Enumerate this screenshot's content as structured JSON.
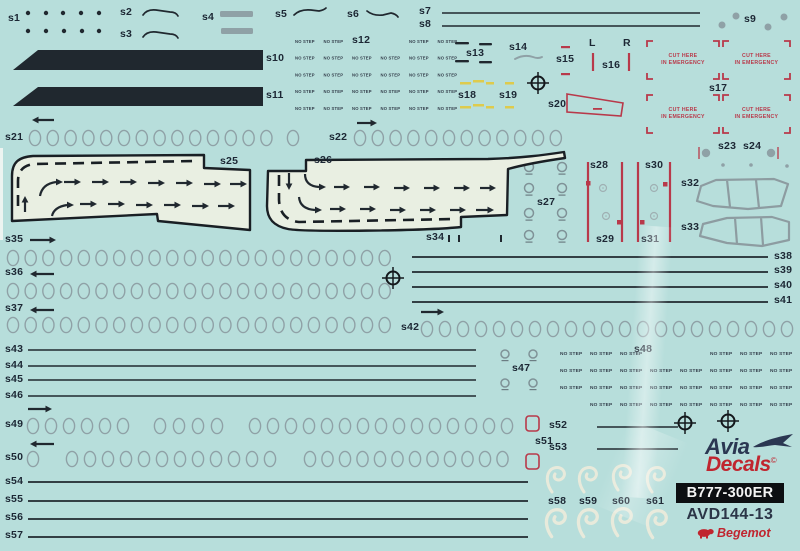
{
  "sheet": {
    "background": "#b7dedb",
    "film": "#e9efe2",
    "ink": "#20282f",
    "gray": "#8fa1a6",
    "red": "#b8394a",
    "yellow": "#decb4d",
    "cream": "#efecdb",
    "label_color": "#1c2734"
  },
  "texts": {
    "no_step": "NO STEP",
    "cut_here_line1": "CUT HERE",
    "cut_here_line2": "IN EMERGENCY"
  },
  "branding": {
    "logo_avia": "Avia",
    "logo_decals": "Decals",
    "copyright": "©",
    "model_badge": "B777-300ER",
    "sku": "AVD144-13",
    "publisher": "Begemot"
  },
  "labels": [
    {
      "t": "s1",
      "x": 8,
      "y": 13
    },
    {
      "t": "s2",
      "x": 120,
      "y": 7
    },
    {
      "t": "s3",
      "x": 120,
      "y": 29
    },
    {
      "t": "s4",
      "x": 202,
      "y": 12
    },
    {
      "t": "s5",
      "x": 275,
      "y": 9
    },
    {
      "t": "s6",
      "x": 347,
      "y": 9
    },
    {
      "t": "s7",
      "x": 419,
      "y": 6
    },
    {
      "t": "s8",
      "x": 419,
      "y": 19
    },
    {
      "t": "s9",
      "x": 744,
      "y": 14
    },
    {
      "t": "s10",
      "x": 266,
      "y": 53
    },
    {
      "t": "s11",
      "x": 266,
      "y": 90
    },
    {
      "t": "s12",
      "x": 352,
      "y": 35
    },
    {
      "t": "s13",
      "x": 466,
      "y": 48
    },
    {
      "t": "s14",
      "x": 509,
      "y": 42
    },
    {
      "t": "s15",
      "x": 556,
      "y": 54
    },
    {
      "t": "s16",
      "x": 602,
      "y": 60
    },
    {
      "t": "s17",
      "x": 709,
      "y": 83
    },
    {
      "t": "s18",
      "x": 458,
      "y": 90
    },
    {
      "t": "s19",
      "x": 499,
      "y": 90
    },
    {
      "t": "s20",
      "x": 548,
      "y": 99
    },
    {
      "t": "s21",
      "x": 5,
      "y": 132
    },
    {
      "t": "s22",
      "x": 329,
      "y": 132
    },
    {
      "t": "s23",
      "x": 718,
      "y": 141
    },
    {
      "t": "s24",
      "x": 743,
      "y": 141
    },
    {
      "t": "s25",
      "x": 220,
      "y": 156
    },
    {
      "t": "s26",
      "x": 314,
      "y": 155
    },
    {
      "t": "s27",
      "x": 537,
      "y": 197
    },
    {
      "t": "s28",
      "x": 590,
      "y": 160
    },
    {
      "t": "s29",
      "x": 596,
      "y": 234
    },
    {
      "t": "s30",
      "x": 645,
      "y": 160
    },
    {
      "t": "s31",
      "x": 641,
      "y": 234
    },
    {
      "t": "s32",
      "x": 681,
      "y": 178
    },
    {
      "t": "s33",
      "x": 681,
      "y": 222
    },
    {
      "t": "s34",
      "x": 426,
      "y": 232
    },
    {
      "t": "s35",
      "x": 5,
      "y": 234
    },
    {
      "t": "s36",
      "x": 5,
      "y": 267
    },
    {
      "t": "s37",
      "x": 5,
      "y": 303
    },
    {
      "t": "s38",
      "x": 774,
      "y": 251
    },
    {
      "t": "s39",
      "x": 774,
      "y": 265
    },
    {
      "t": "s40",
      "x": 774,
      "y": 280
    },
    {
      "t": "s41",
      "x": 774,
      "y": 295
    },
    {
      "t": "s42",
      "x": 401,
      "y": 322
    },
    {
      "t": "s43",
      "x": 5,
      "y": 344
    },
    {
      "t": "s44",
      "x": 5,
      "y": 360
    },
    {
      "t": "s45",
      "x": 5,
      "y": 374
    },
    {
      "t": "s46",
      "x": 5,
      "y": 390
    },
    {
      "t": "s47",
      "x": 512,
      "y": 363
    },
    {
      "t": "s48",
      "x": 634,
      "y": 344
    },
    {
      "t": "s49",
      "x": 5,
      "y": 419
    },
    {
      "t": "s50",
      "x": 5,
      "y": 452
    },
    {
      "t": "s51",
      "x": 535,
      "y": 436
    },
    {
      "t": "s52",
      "x": 549,
      "y": 420
    },
    {
      "t": "s53",
      "x": 549,
      "y": 442
    },
    {
      "t": "s54",
      "x": 5,
      "y": 476
    },
    {
      "t": "s55",
      "x": 5,
      "y": 494
    },
    {
      "t": "s56",
      "x": 5,
      "y": 512
    },
    {
      "t": "s57",
      "x": 5,
      "y": 530
    },
    {
      "t": "s58",
      "x": 548,
      "y": 496
    },
    {
      "t": "s59",
      "x": 579,
      "y": 496
    },
    {
      "t": "s60",
      "x": 612,
      "y": 496
    },
    {
      "t": "s61",
      "x": 646,
      "y": 496
    },
    {
      "t": "L",
      "x": 589,
      "y": 38
    },
    {
      "t": "R",
      "x": 623,
      "y": 38
    }
  ],
  "art": {
    "stripes": [
      "38,50 263,50 263,70 13,70",
      "38,87 263,87 263,106 13,106"
    ],
    "gray_bars": [
      [
        220,
        11,
        33,
        6
      ],
      [
        221,
        28,
        32,
        6
      ]
    ],
    "lines": [
      [
        442,
        13,
        700,
        13,
        1.6
      ],
      [
        442,
        26,
        700,
        26,
        1.6
      ],
      [
        412,
        257,
        768,
        257,
        1.7
      ],
      [
        412,
        272,
        768,
        272,
        1.7
      ],
      [
        412,
        287,
        768,
        287,
        1.7
      ],
      [
        412,
        302,
        768,
        302,
        1.7
      ],
      [
        28,
        350,
        476,
        350,
        1.6
      ],
      [
        28,
        366,
        476,
        366,
        1.6
      ],
      [
        28,
        380,
        476,
        380,
        1.6
      ],
      [
        28,
        396,
        476,
        396,
        1.6
      ],
      [
        597,
        427,
        678,
        427,
        1.4
      ],
      [
        597,
        449,
        678,
        449,
        1.4
      ],
      [
        28,
        482,
        528,
        482,
        1.7
      ],
      [
        28,
        501,
        528,
        501,
        1.7
      ],
      [
        28,
        519,
        528,
        519,
        1.7
      ],
      [
        28,
        537,
        528,
        537,
        1.7
      ]
    ],
    "red_lines": [
      [
        593,
        53,
        18
      ],
      [
        629,
        53,
        18
      ],
      [
        588,
        162,
        80
      ],
      [
        622,
        162,
        80
      ],
      [
        638,
        162,
        80
      ],
      [
        670,
        162,
        80
      ]
    ],
    "black_dots": [
      [
        28,
        13
      ],
      [
        46,
        13
      ],
      [
        63,
        13
      ],
      [
        81,
        13
      ],
      [
        99,
        13
      ],
      [
        28,
        31
      ],
      [
        46,
        31
      ],
      [
        64,
        31
      ],
      [
        82,
        31
      ],
      [
        99,
        31
      ]
    ],
    "gray_dots": [
      [
        722,
        25,
        3.5
      ],
      [
        736,
        16,
        3.5
      ],
      [
        768,
        27,
        3.5
      ],
      [
        784,
        17,
        3.5
      ],
      [
        723,
        165,
        1.8
      ],
      [
        751,
        165,
        1.8
      ],
      [
        787,
        166,
        1.8
      ]
    ],
    "paths": [
      {
        "d": "M143,15 Q147,9 156,10 L170,12 Q176,12 178,16",
        "w": 1.7
      },
      {
        "d": "M143,37 Q147,31 156,32 L170,34 Q176,34 178,38",
        "w": 1.7
      },
      {
        "d": "M294,15 Q300,9 311,10 L319,11 Q324,10 326,8",
        "w": 1.7
      },
      {
        "d": "M367,11 Q373,16 383,15 L391,13 Q396,14 398,17",
        "w": 1.7
      },
      {
        "d": "M515,59 Q524,54 533,57 Q538,59 542,57",
        "w": 1.9,
        "c": "gray"
      }
    ],
    "oval_rows": [
      {
        "y": 138,
        "runs": [
          [
            35,
            14,
            17.8
          ],
          [
            293,
            1,
            0
          ],
          [
            360,
            12,
            17.8
          ]
        ]
      },
      {
        "y": 258,
        "runs": [
          [
            13,
            22,
            17.7
          ]
        ]
      },
      {
        "y": 291,
        "runs": [
          [
            13,
            22,
            17.7
          ]
        ]
      },
      {
        "y": 325,
        "runs": [
          [
            13,
            22,
            17.7
          ]
        ]
      },
      {
        "y": 329,
        "runs": [
          [
            427,
            21,
            18
          ]
        ]
      },
      {
        "y": 426,
        "runs": [
          [
            33,
            6,
            18
          ],
          [
            160,
            4,
            19
          ],
          [
            255,
            15,
            18
          ]
        ]
      },
      {
        "y": 459,
        "runs": [
          [
            33,
            1,
            0
          ],
          [
            72,
            12,
            18
          ],
          [
            310,
            12,
            17.5
          ]
        ]
      }
    ],
    "arrows": [
      [
        32,
        120,
        22,
        "l"
      ],
      [
        357,
        123,
        20,
        "r"
      ],
      [
        30,
        240,
        26,
        "r"
      ],
      [
        30,
        274,
        24,
        "l"
      ],
      [
        30,
        310,
        24,
        "l"
      ],
      [
        421,
        312,
        23,
        "r"
      ],
      [
        28,
        409,
        24,
        "r"
      ],
      [
        30,
        444,
        24,
        "l"
      ]
    ],
    "crosshairs": [
      [
        538,
        83
      ],
      [
        393,
        278
      ],
      [
        728,
        421
      ],
      [
        685,
        423
      ]
    ],
    "nostep_grids": [
      {
        "x0": 295,
        "y0": 43,
        "dx": 28.5,
        "dy": 16.7,
        "cols": 6,
        "rows": 5,
        "fs": 4.2,
        "skip": [
          [
            0,
            2
          ],
          [
            0,
            3
          ]
        ]
      },
      {
        "x0": 560,
        "y0": 355,
        "dx": 30,
        "dy": 17,
        "cols": 8,
        "rows": 4,
        "fs": 4.8,
        "skip": [
          [
            0,
            3
          ],
          [
            0,
            4
          ],
          [
            3,
            0
          ]
        ]
      }
    ],
    "cut_boxes": [
      [
        647,
        41,
        72,
        38
      ],
      [
        723,
        41,
        67,
        38
      ],
      [
        647,
        95,
        72,
        38
      ],
      [
        723,
        95,
        67,
        38
      ]
    ],
    "red_squares": [
      [
        586,
        181
      ],
      [
        617,
        220
      ],
      [
        663,
        182
      ],
      [
        640,
        220
      ]
    ],
    "red_outline_squares": [
      [
        526,
        416
      ],
      [
        526,
        454
      ]
    ],
    "red_dashes": [
      [
        561,
        46,
        9,
        2.2
      ],
      [
        561,
        73,
        9,
        2.2
      ],
      [
        593,
        108,
        9,
        1.8
      ]
    ],
    "yellow_dashes": [
      [
        460,
        82,
        11,
        2.5
      ],
      [
        473,
        80,
        11,
        2.5
      ],
      [
        486,
        82,
        8,
        2.5
      ],
      [
        460,
        106,
        11,
        2.5
      ],
      [
        473,
        104,
        11,
        2.5
      ],
      [
        486,
        106,
        8,
        2.5
      ],
      [
        505,
        82,
        9,
        2.5
      ],
      [
        505,
        106,
        9,
        2.5
      ]
    ],
    "black_dashes": [
      [
        455,
        42,
        14,
        2.4
      ],
      [
        479,
        43,
        13,
        2.4
      ],
      [
        455,
        60,
        14,
        2.4
      ],
      [
        479,
        61,
        13,
        2.4
      ]
    ],
    "ticks": [
      [
        448,
        235
      ],
      [
        458,
        235
      ],
      [
        500,
        235
      ]
    ],
    "trapezoid": "567,94 623,103 621,116 567,112",
    "rings": [
      [
        529,
        167,
        4.5
      ],
      [
        562,
        167,
        4.5
      ],
      [
        529,
        188,
        4.5
      ],
      [
        562,
        188,
        4.5
      ],
      [
        529,
        213,
        4.5
      ],
      [
        562,
        213,
        4.5
      ],
      [
        529,
        235,
        4.5
      ],
      [
        562,
        235,
        4.5
      ],
      [
        505,
        354,
        4
      ],
      [
        533,
        354,
        4
      ],
      [
        505,
        383,
        4
      ],
      [
        533,
        383,
        4
      ]
    ],
    "faint_rings": [
      [
        603,
        188
      ],
      [
        606,
        216
      ],
      [
        654,
        188
      ],
      [
        654,
        216
      ]
    ],
    "markers": [
      [
        706,
        153,
        699
      ],
      [
        771,
        153,
        778
      ]
    ],
    "windows": [
      "M701,186 L716,180 L774,179 L788,184 L781,206 L748,209 L713,206 L697,201 Z M727,180 L730,207 M756,180 L759,208",
      "M703,224 L727,218 L772,217 L789,222 L789,240 L762,246 L727,243 L700,236 Z M735,218 L737,244 M761,217 L763,245"
    ],
    "walkways": [
      {
        "film": "M33,156 C19,157 12,162 12,176 L12,221 L157,214 L158,221 L250,230 L250,170 L204,168 L204,155 Z",
        "dash": "M18,206 L18,181 Q18,166 34,164 L195,161",
        "arrows": [
          [
            64,
            182,
            17,
            "r"
          ],
          [
            92,
            182,
            17,
            "r"
          ],
          [
            120,
            182,
            17,
            "r"
          ],
          [
            148,
            183,
            17,
            "r"
          ],
          [
            176,
            183,
            17,
            "r"
          ],
          [
            204,
            184,
            17,
            "r"
          ],
          [
            230,
            184,
            17,
            "r"
          ],
          [
            80,
            204,
            17,
            "r"
          ],
          [
            108,
            204,
            17,
            "r"
          ],
          [
            136,
            205,
            17,
            "r"
          ],
          [
            164,
            205,
            17,
            "r"
          ],
          [
            192,
            206,
            17,
            "r"
          ],
          [
            218,
            206,
            17,
            "r"
          ],
          [
            25,
            212,
            16,
            "u"
          ]
        ],
        "curves": [
          {
            "d": "M40,196 Q42,184 56,182",
            "hx": 58,
            "hy": 182
          },
          {
            "d": "M52,216 Q54,207 67,205",
            "hx": 69,
            "hy": 205
          }
        ]
      },
      {
        "film": "M268,171 L306,171 L306,160 L488,159 C522,158 544,155 564,152 L565,158 C544,161 526,164 508,169 L507,215 L461,217 L461,227 C424,231 303,232 288,229 C273,226 267,218 267,206 Z",
        "dash": "M279,175 L279,200 Q280,220 299,222 L455,219",
        "arrows": [
          [
            334,
            187,
            16,
            "r"
          ],
          [
            364,
            187,
            16,
            "r"
          ],
          [
            394,
            188,
            16,
            "r"
          ],
          [
            424,
            188,
            16,
            "r"
          ],
          [
            454,
            188,
            16,
            "r"
          ],
          [
            480,
            188,
            16,
            "r"
          ],
          [
            330,
            209,
            16,
            "r"
          ],
          [
            360,
            209,
            16,
            "r"
          ],
          [
            390,
            210,
            16,
            "r"
          ],
          [
            420,
            210,
            16,
            "r"
          ],
          [
            450,
            210,
            16,
            "r"
          ],
          [
            476,
            210,
            18,
            "r"
          ],
          [
            289,
            173,
            17,
            "d"
          ]
        ],
        "curves": [
          {
            "d": "M305,174 Q305,186 319,187",
            "hx": 321,
            "hy": 187
          },
          {
            "d": "M299,197 Q300,209 315,210",
            "hx": 317,
            "hy": 210
          }
        ]
      }
    ],
    "swirl_path": "M6,26 C1,19 0,11 3,6 C6,1 13,0 17,4 C20,8 18,13 13,14 C9,14 7,11 9,8",
    "swirls": [
      [
        546,
        466,
        1
      ],
      [
        578,
        466,
        1
      ],
      [
        612,
        464,
        1
      ],
      [
        646,
        466,
        1
      ],
      [
        545,
        508,
        1.1
      ],
      [
        577,
        508,
        1.1
      ],
      [
        611,
        507,
        1.1
      ],
      [
        646,
        509,
        1.1
      ]
    ],
    "white_edges": [
      [
        0,
        148,
        3,
        92
      ]
    ]
  }
}
